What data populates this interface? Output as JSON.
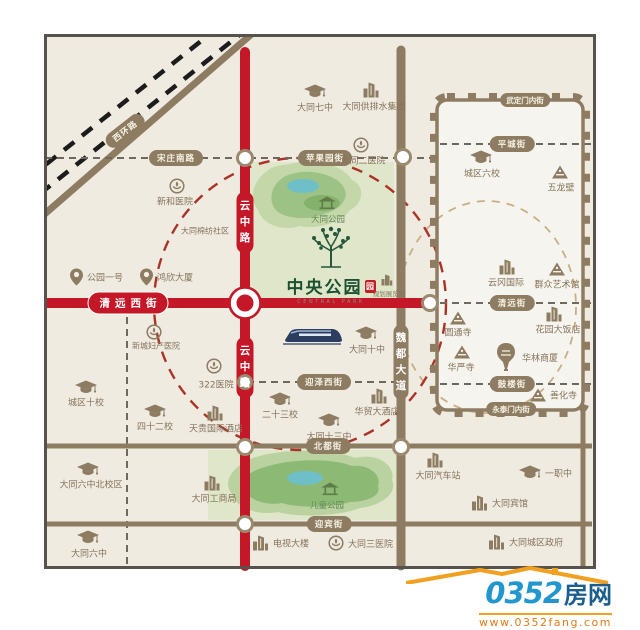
{
  "project": {
    "name": "中央公园",
    "name_en": "CENTRAL PARK",
    "seal_char": "园"
  },
  "watermark": {
    "number": "0352",
    "word": "房网",
    "url": "www.0352fang.com"
  },
  "colors": {
    "road_red": "#c41829",
    "road_tan": "#8d7c62",
    "dash_gray": "#6f685e",
    "green_block": "#dfe6c9",
    "circle_red": "#aa3328",
    "circle_tan": "#c8ae85",
    "poi_text": "#85735a",
    "park_text": "#68895a",
    "logo_green": "#1c5031",
    "wm_blue": "#2196cf",
    "wm_orange": "#f2a01f"
  },
  "street_labels": [
    {
      "label": "西环路",
      "x": 125,
      "y": 131,
      "kind": "pill",
      "rotate": -38
    },
    {
      "label": "宋庄南路",
      "x": 176,
      "y": 158,
      "kind": "pill"
    },
    {
      "label": "苹果园街",
      "x": 325,
      "y": 158,
      "kind": "pill"
    },
    {
      "label": "武定门内街",
      "x": 525,
      "y": 100,
      "kind": "pill small"
    },
    {
      "label": "平城街",
      "x": 512,
      "y": 144,
      "kind": "pill"
    },
    {
      "label": "清远街",
      "x": 512,
      "y": 303,
      "kind": "pill"
    },
    {
      "label": "鼓楼街",
      "x": 512,
      "y": 384,
      "kind": "pill"
    },
    {
      "label": "永泰门内街",
      "x": 511,
      "y": 409,
      "kind": "pill small"
    },
    {
      "label": "迎泽西街",
      "x": 324,
      "y": 382,
      "kind": "pill"
    },
    {
      "label": "北都街",
      "x": 328,
      "y": 446,
      "kind": "pill"
    },
    {
      "label": "迎宾街",
      "x": 329,
      "y": 524,
      "kind": "pill"
    },
    {
      "label": "清远西街",
      "x": 128,
      "y": 303,
      "kind": "pill red"
    }
  ],
  "road_names_vertical": [
    {
      "text": "云中路",
      "x": 245,
      "y": 222
    },
    {
      "text": "云中路",
      "x": 245,
      "y": 367
    },
    {
      "text": "魏都大道",
      "x": 401,
      "y": 362
    }
  ],
  "pois": [
    {
      "icon": "graduation-cap-icon",
      "label": "大同七中",
      "x": 315,
      "y": 107,
      "ix": 315,
      "iy": 92
    },
    {
      "icon": "building-icon",
      "label": "大同供排水集团",
      "x": 374,
      "y": 106,
      "ix": 371,
      "iy": 90
    },
    {
      "icon": "hospital-badge-icon",
      "label": "大同二医院",
      "x": 363,
      "y": 160,
      "ix": 361,
      "iy": 145
    },
    {
      "icon": "graduation-cap-icon",
      "label": "城区六校",
      "x": 482,
      "y": 173,
      "ix": 481,
      "iy": 158
    },
    {
      "icon": "temple-icon",
      "label": "五龙壁",
      "x": 561,
      "y": 187,
      "ix": 560,
      "iy": 172
    },
    {
      "icon": "hospital-badge-icon",
      "label": "新和医院",
      "x": 175,
      "y": 201,
      "ix": 177,
      "iy": 186
    },
    {
      "icon": "none",
      "label": "大同棉纺社区",
      "x": 205,
      "y": 231,
      "cls": "md"
    },
    {
      "icon": "map-pin-icon",
      "label": "公园一号",
      "inline": true,
      "lx": 70,
      "y": 277
    },
    {
      "icon": "map-pin-icon",
      "label": "鸿欣大厦",
      "inline": true,
      "lx": 140,
      "y": 277
    },
    {
      "icon": "hospital-badge-icon",
      "label": "322医院",
      "x": 216,
      "y": 384,
      "ix": 214,
      "iy": 366
    },
    {
      "icon": "hospital-badge-icon",
      "label": "新城妇产医院",
      "x": 156,
      "y": 346,
      "ix": 154,
      "iy": 332,
      "cls": "md"
    },
    {
      "icon": "graduation-cap-icon",
      "label": "城区十校",
      "x": 86,
      "y": 402,
      "ix": 86,
      "iy": 388
    },
    {
      "icon": "graduation-cap-icon",
      "label": "四十二校",
      "x": 155,
      "y": 426,
      "ix": 155,
      "iy": 412
    },
    {
      "icon": "building-icon",
      "label": "天贵国际酒店",
      "x": 216,
      "y": 428,
      "ix": 215,
      "iy": 413
    },
    {
      "icon": "graduation-cap-icon",
      "label": "大同六中北校区",
      "x": 91,
      "y": 484,
      "ix": 88,
      "iy": 470
    },
    {
      "icon": "graduation-cap-icon",
      "label": "大同十中",
      "x": 367,
      "y": 349,
      "ix": 366,
      "iy": 334
    },
    {
      "icon": "graduation-cap-icon",
      "label": "二十三校",
      "x": 280,
      "y": 414,
      "ix": 280,
      "iy": 400
    },
    {
      "icon": "graduation-cap-icon",
      "label": "大同十三中",
      "x": 329,
      "y": 436,
      "ix": 329,
      "iy": 421
    },
    {
      "icon": "building-icon",
      "label": "华贸大酒店",
      "x": 377,
      "y": 411,
      "ix": 379,
      "iy": 396
    },
    {
      "icon": "building-icon",
      "label": "云冈国际",
      "x": 506,
      "y": 282,
      "ix": 507,
      "iy": 267
    },
    {
      "icon": "temple-icon",
      "label": "群众艺术馆",
      "x": 557,
      "y": 284,
      "ix": 557,
      "iy": 269
    },
    {
      "icon": "temple-icon",
      "label": "圆通寺",
      "x": 458,
      "y": 332,
      "ix": 458,
      "iy": 318
    },
    {
      "icon": "building-icon",
      "label": "花园大饭店",
      "x": 558,
      "y": 329,
      "ix": 554,
      "iy": 314
    },
    {
      "icon": "temple-icon",
      "label": "华严寺",
      "x": 461,
      "y": 367,
      "ix": 462,
      "iy": 352
    },
    {
      "icon": "pagoda-icon",
      "label": "华林商厦",
      "inline": true,
      "lx": 494,
      "y": 357
    },
    {
      "icon": "temple-icon",
      "label": "善化寺",
      "inline": true,
      "lx": 530,
      "y": 395
    },
    {
      "icon": "building-icon",
      "label": "大同工商局",
      "x": 214,
      "y": 498,
      "ix": 212,
      "iy": 483
    },
    {
      "icon": "building-icon",
      "label": "电视大楼",
      "inline": true,
      "lx": 252,
      "y": 543
    },
    {
      "icon": "hospital-badge-icon",
      "label": "大同三医院",
      "inline": true,
      "lx": 328,
      "y": 543
    },
    {
      "icon": "building-icon",
      "label": "大同汽车站",
      "x": 438,
      "y": 475,
      "ix": 435,
      "iy": 460
    },
    {
      "icon": "graduation-cap-icon",
      "label": "一职中",
      "inline": true,
      "lx": 519,
      "y": 473
    },
    {
      "icon": "building-icon",
      "label": "大同宾馆",
      "inline": true,
      "lx": 471,
      "y": 503
    },
    {
      "icon": "building-icon",
      "label": "大同城区政府",
      "inline": true,
      "lx": 488,
      "y": 542
    },
    {
      "icon": "graduation-cap-icon",
      "label": "大同六中",
      "x": 89,
      "y": 553,
      "ix": 88,
      "iy": 538
    },
    {
      "icon": "building-sm-icon",
      "label": "规划展览馆",
      "x": 389,
      "y": 293,
      "ix": 387,
      "iy": 280,
      "cls": "tiny"
    },
    {
      "icon": "pavilion-icon",
      "label": "大同公园",
      "x": 328,
      "y": 219,
      "ix": 327,
      "iy": 203,
      "cls": "park"
    },
    {
      "icon": "pavilion-icon",
      "label": "儿童公园",
      "x": 327,
      "y": 505,
      "ix": 330,
      "iy": 489,
      "cls": "park"
    }
  ]
}
